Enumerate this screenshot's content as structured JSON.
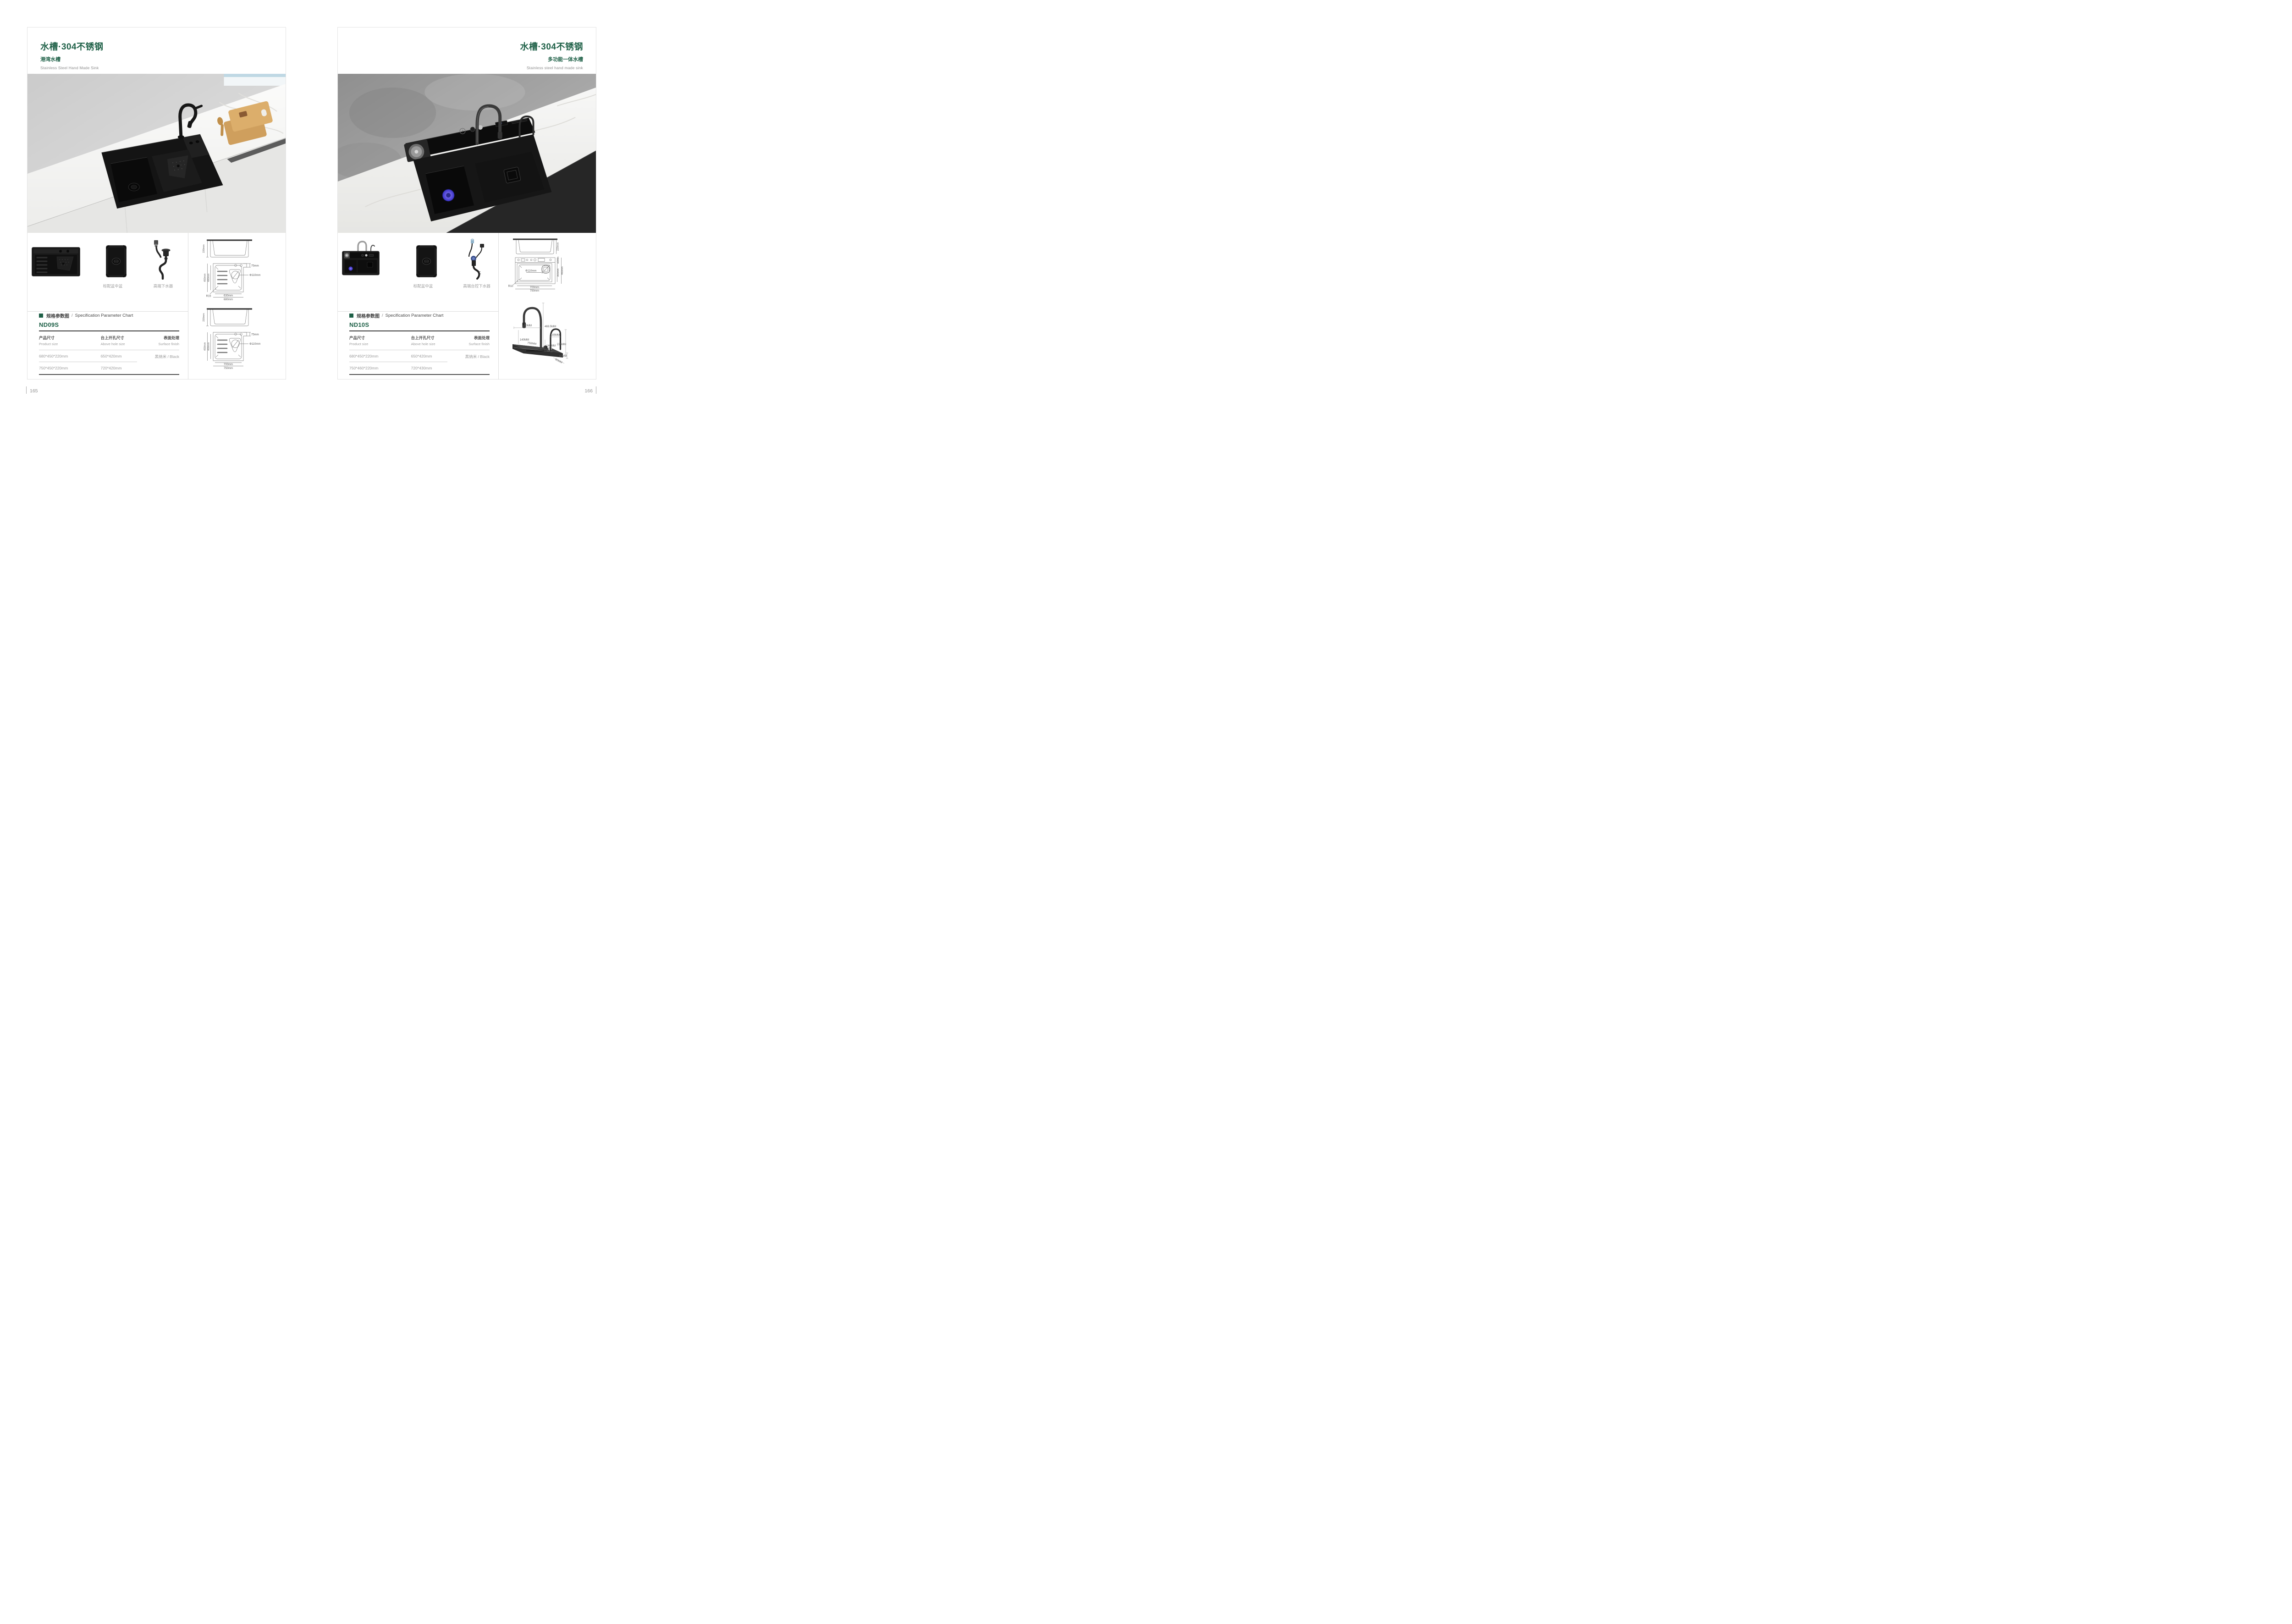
{
  "accent_color": "#1e6047",
  "left_page": {
    "title": "水槽·304不锈钢",
    "subtitle": "港湾水槽",
    "subtitle_en": "Stainless Steel Hand Made Sink",
    "thumbnails": {
      "caption_1": "标配盆中盆",
      "caption_2": "高端下水器"
    },
    "spec": {
      "section_cn": "规格参数图",
      "sep": "/",
      "section_en": "Specification Parameter Chart",
      "model": "ND09S",
      "col1_cn": "产品尺寸",
      "col1_en": "Product size",
      "col2_cn": "台上开孔尺寸",
      "col2_en": "Above hole size",
      "col3_cn": "表面处理",
      "col3_en": "Surface finish",
      "rows": [
        {
          "size": "680*450*220mm",
          "hole": "650*420mm",
          "finish": "黑纳米 / Black"
        },
        {
          "size": "750*450*220mm",
          "hole": "720*420mm",
          "finish": ""
        }
      ]
    },
    "drawings": {
      "g1": {
        "h": "220mm",
        "od": "450mm",
        "idm": "400mm",
        "ledge": "75mm",
        "drain": "Φ110mm",
        "r": "R15",
        "iw": "630mm",
        "ow": "680mm"
      },
      "g2": {
        "h": "220mm",
        "od": "450mm",
        "idm": "400mm",
        "ledge": "75mm",
        "drain": "Φ110mm",
        "iw": "700mm",
        "ow": "750mm"
      }
    },
    "page_number": "165"
  },
  "right_page": {
    "title": "水槽·304不锈钢",
    "subtitle": "多功能一体水槽",
    "subtitle_en": "Stainless steel hand made sink",
    "thumbnails": {
      "caption_1": "标配盆中盆",
      "caption_2": "高端台控下水器"
    },
    "spec": {
      "section_cn": "规格参数图",
      "sep": "/",
      "section_en": "Specification Parameter Chart",
      "model": "ND10S",
      "col1_cn": "产品尺寸",
      "col1_en": "Product size",
      "col2_cn": "台上开孔尺寸",
      "col2_en": "Above hole size",
      "col3_cn": "表面处理",
      "col3_en": "Surface finish",
      "rows": [
        {
          "size": "680*450*220mm",
          "hole": "650*420mm",
          "finish": "黑纳米 / Black"
        },
        {
          "size": "750*460*220mm",
          "hole": "720*430mm",
          "finish": ""
        }
      ]
    },
    "drawings": {
      "g1": {
        "h": "220mm",
        "deck": "80mm",
        "idm": "355mm",
        "od": "460mm",
        "drain": "Φ110mm",
        "r": "R10",
        "iw": "700mm",
        "ow": "750mm"
      },
      "faucet": {
        "reach": "250MM",
        "height": "469.5MM",
        "clear1": "140MM",
        "length": "750MM",
        "reach2": "145MM",
        "clear2": "140MM",
        "height2": "225MM",
        "deck_h": "40MM",
        "deck_d": "80MM"
      }
    },
    "page_number": "166"
  }
}
